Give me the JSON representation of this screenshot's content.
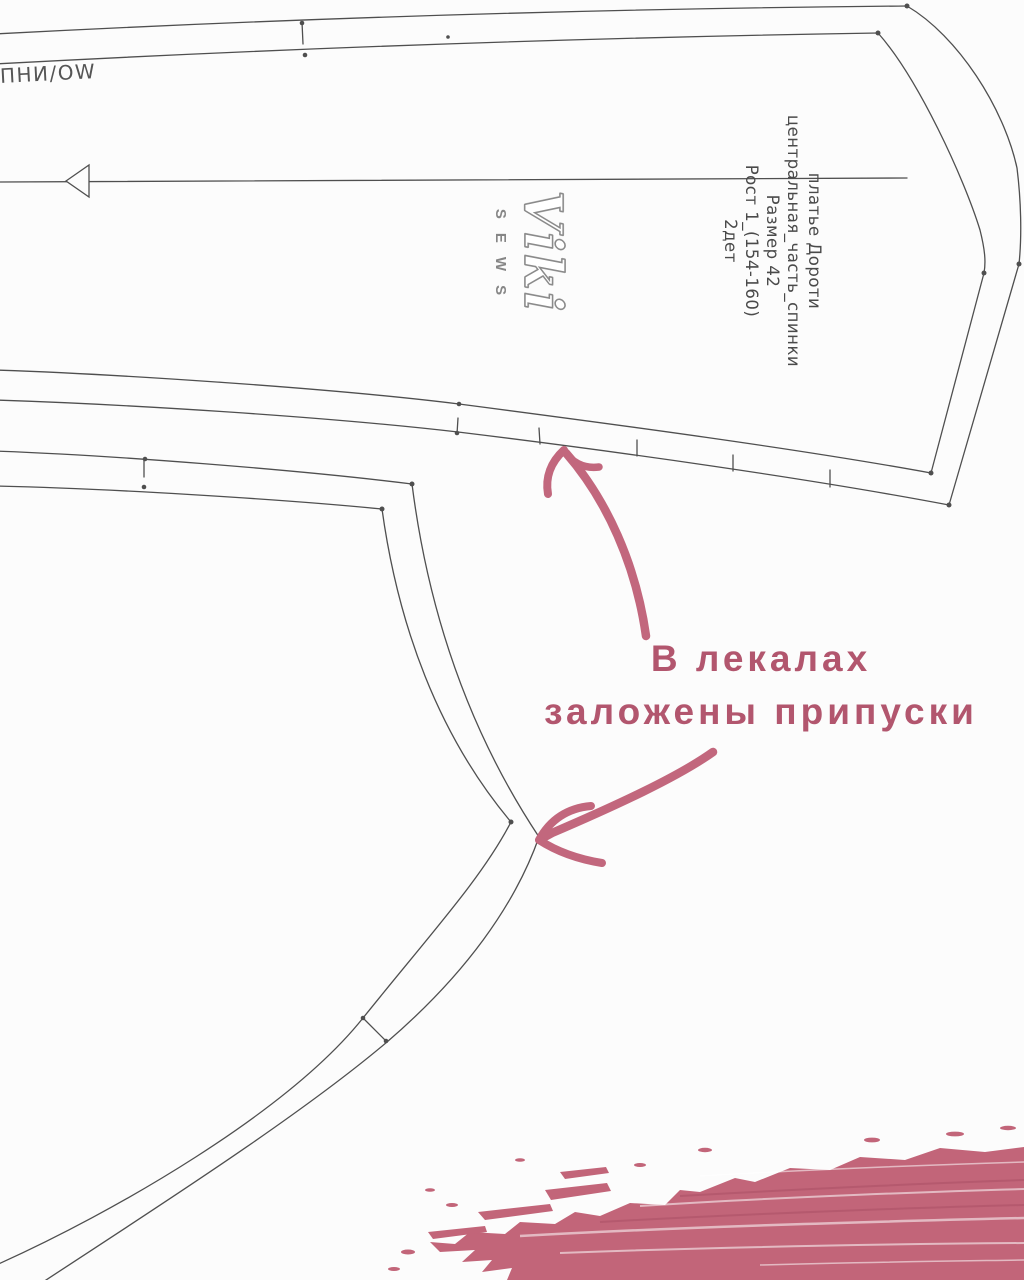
{
  "meta": {
    "width": 1024,
    "height": 1280
  },
  "colors": {
    "line": "#4f4f4f",
    "text": "#4a4a4a",
    "pink_text": "#b2566e",
    "pink_arrow": "#c2677d",
    "pink_brush": "#c26579",
    "paper": "#fcfcfc",
    "logo_gray": "#8a8a8a"
  },
  "edge_text": "ПНИ/ОW",
  "pattern_label": {
    "lines": [
      "платье  Дороти",
      "центральная_часть_спинки",
      "Размер  42",
      "Рост  1_(154-160)",
      "2дет"
    ]
  },
  "logo": {
    "script": "Viki",
    "word": "SEWS"
  },
  "annotation": {
    "lines": [
      "В лекалах",
      "заложены припуски"
    ]
  }
}
